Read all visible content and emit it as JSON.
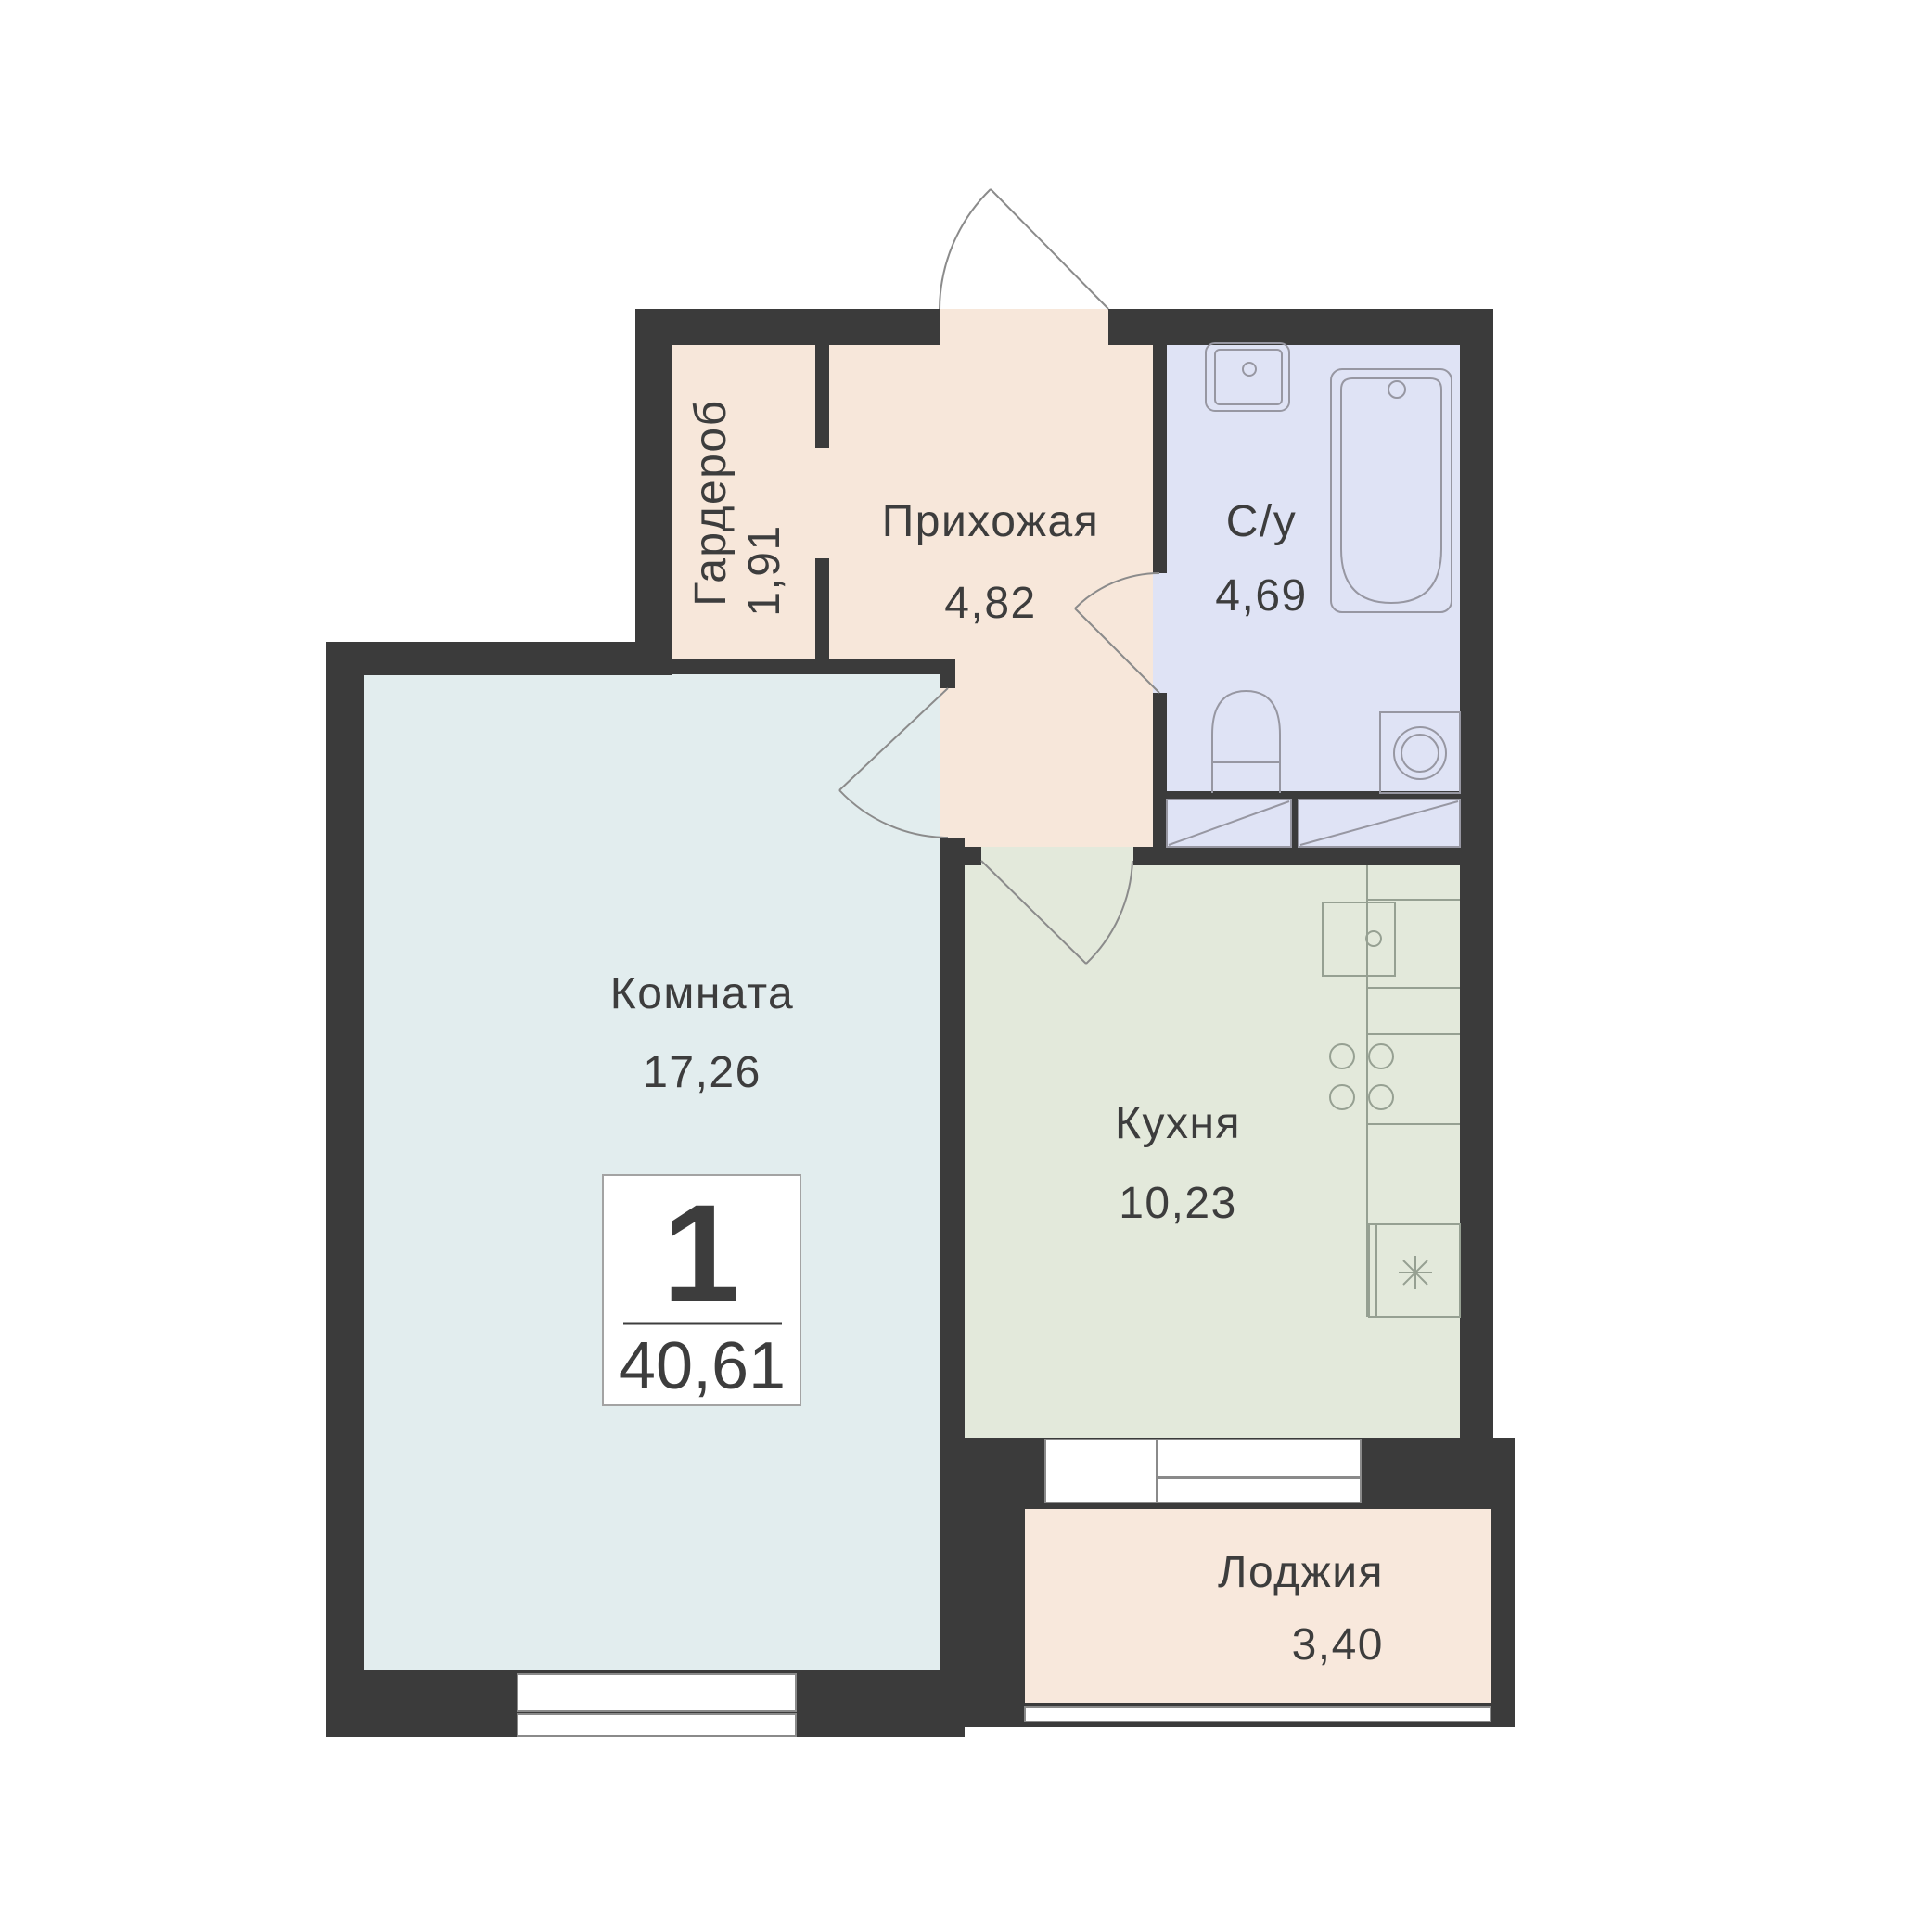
{
  "floorplan": {
    "badge": {
      "rooms_count": "1",
      "total_area": "40,61"
    },
    "rooms": {
      "wardrobe": {
        "name": "Гардероб",
        "area": "1,91"
      },
      "hallway": {
        "name": "Прихожая",
        "area": "4,82"
      },
      "bathroom": {
        "name": "С/у",
        "area": "4,69"
      },
      "living": {
        "name": "Комната",
        "area": "17,26"
      },
      "kitchen": {
        "name": "Кухня",
        "area": "10,23"
      },
      "loggia": {
        "name": "Лоджия",
        "area": "3,40"
      }
    },
    "colors": {
      "wall": "#3b3b3b",
      "hall_floor": "#f7e7da",
      "bath_floor": "#dfe3f5",
      "kitchen_floor": "#e3e9db",
      "room_floor": "#e2edee",
      "loggia_floor": "#f8e8dc",
      "text": "#3d3d3d"
    }
  }
}
